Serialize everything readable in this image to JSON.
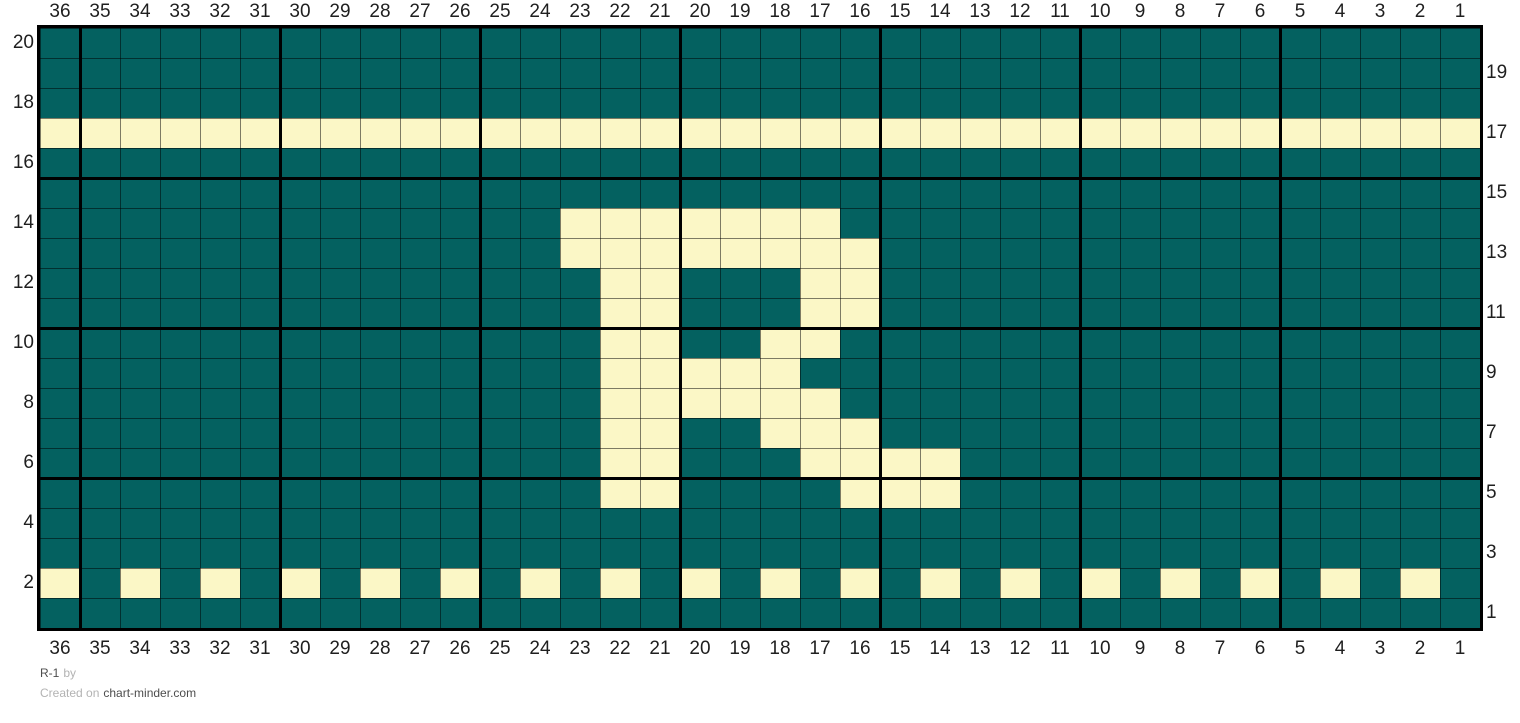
{
  "chart_data": {
    "type": "heatmap",
    "title": "R-1",
    "columns": 36,
    "rows": 20,
    "column_labels": [
      "36",
      "35",
      "34",
      "33",
      "32",
      "31",
      "30",
      "29",
      "28",
      "27",
      "26",
      "25",
      "24",
      "23",
      "22",
      "21",
      "20",
      "19",
      "18",
      "17",
      "16",
      "15",
      "14",
      "13",
      "12",
      "11",
      "10",
      "9",
      "8",
      "7",
      "6",
      "5",
      "4",
      "3",
      "2",
      "1"
    ],
    "row_labels_left": [
      "20",
      "18",
      "16",
      "14",
      "12",
      "10",
      "8",
      "6",
      "4",
      "2"
    ],
    "row_labels_right": [
      "19",
      "17",
      "15",
      "13",
      "11",
      "9",
      "7",
      "5",
      "3",
      "1"
    ],
    "palette": {
      "0": "#046160",
      "1": "#FBF7C6"
    },
    "palette_names": {
      "0": "teal",
      "1": "cream"
    },
    "block_size": 5,
    "legend_position": "none",
    "grid": [
      "000000000000000000000000000000000000",
      "000000000000000000000000000000000000",
      "000000000000000000000000000000000000",
      "111111111111111111111111111111111111",
      "000000000000000000000000000000000000",
      "000000000000000000000000000000000000",
      "000000000000011111110000000000000000",
      "000000000000011111111000000000000000",
      "000000000000001100011000000000000000",
      "000000000000001100011000000000000000",
      "000000000000001100110000000000000000",
      "000000000000001111100000000000000000",
      "000000000000001111110000000000000000",
      "000000000000001100111000000000000000",
      "000000000000001100011110000000000000",
      "000000000000001100001110000000000000",
      "000000000000000000000000000000000000",
      "000000000000000000000000000000000000",
      "101010101010101010101010101010101010",
      "000000000000000000000000000000000000"
    ]
  },
  "footer": {
    "title": "R-1",
    "by_label": "by",
    "created_on_label": "Created on",
    "site": "chart-minder.com"
  }
}
